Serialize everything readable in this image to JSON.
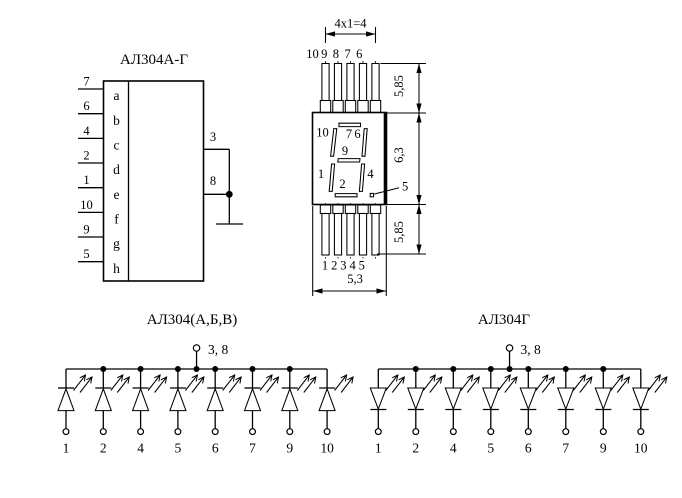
{
  "pin_diagram": {
    "title": "АЛ304А-Г",
    "left_pins": [
      {
        "pin": "7",
        "segment": "a"
      },
      {
        "pin": "6",
        "segment": "b"
      },
      {
        "pin": "4",
        "segment": "c"
      },
      {
        "pin": "2",
        "segment": "d"
      },
      {
        "pin": "1",
        "segment": "e"
      },
      {
        "pin": "10",
        "segment": "f"
      },
      {
        "pin": "9",
        "segment": "g"
      },
      {
        "pin": "5",
        "segment": "h"
      }
    ],
    "right_pins": [
      {
        "pin": "3"
      },
      {
        "pin": "8"
      }
    ]
  },
  "package_drawing": {
    "pitch_dimension": "4x1=4",
    "top_pin_numbers": [
      "10",
      "9",
      "8",
      "7",
      "6"
    ],
    "bottom_pin_numbers": [
      "1",
      "2",
      "3",
      "4",
      "5"
    ],
    "dimensions": {
      "top_lead_length": "5,85",
      "body_height": "6,3",
      "bottom_lead_length": "5,85",
      "body_width": "5,3"
    },
    "segment_labels": {
      "top_left": "10",
      "top": "7",
      "top_right": "6",
      "middle": "9",
      "bottom_left": "1",
      "bottom": "2",
      "bottom_right": "4",
      "decimal_point": "5"
    }
  },
  "schematics": [
    {
      "title": "АЛ304(А,Б,В)",
      "common_label": "3, 8",
      "pins": [
        "1",
        "2",
        "4",
        "5",
        "6",
        "7",
        "9",
        "10"
      ]
    },
    {
      "title": "АЛ304Г",
      "common_label": "3, 8",
      "pins": [
        "1",
        "2",
        "4",
        "5",
        "6",
        "7",
        "9",
        "10"
      ]
    }
  ]
}
